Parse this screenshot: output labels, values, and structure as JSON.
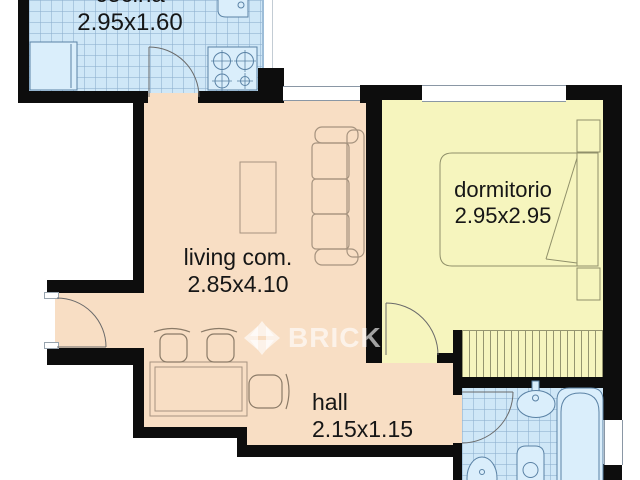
{
  "watermark": {
    "brand": "BRICK"
  },
  "rooms": {
    "cocina": {
      "label": "cocina",
      "dimensions": "2.95x1.60"
    },
    "living": {
      "label": "living com.",
      "dimensions": "2.85x4.10"
    },
    "dormitorio": {
      "label": "dormitorio",
      "dimensions": "2.95x2.95"
    },
    "hall": {
      "label": "hall",
      "dimensions": "2.15x1.15"
    }
  },
  "colors": {
    "floor_peach": "#f8dec4",
    "floor_yellow": "#f6f5be",
    "tile_blue": "#cfe7f7",
    "fixture_blue": "#daeefb",
    "fixture_stroke": "#5a82a5",
    "wall": "#0d0d0d",
    "watermark_white": "rgba(255,255,255,0.62)"
  },
  "fixture_icons": [
    "fridge-icon",
    "stove-icon",
    "kitchen-sink-icon",
    "sofa-icon",
    "coffee-table-icon",
    "dining-table-icon",
    "chair-icon",
    "desk-chair-icon",
    "bed-icon",
    "nightstand-icon",
    "wardrobe-icon",
    "washbasin-icon",
    "bathtub-icon",
    "toilet-icon",
    "bidet-icon",
    "door-icon"
  ]
}
